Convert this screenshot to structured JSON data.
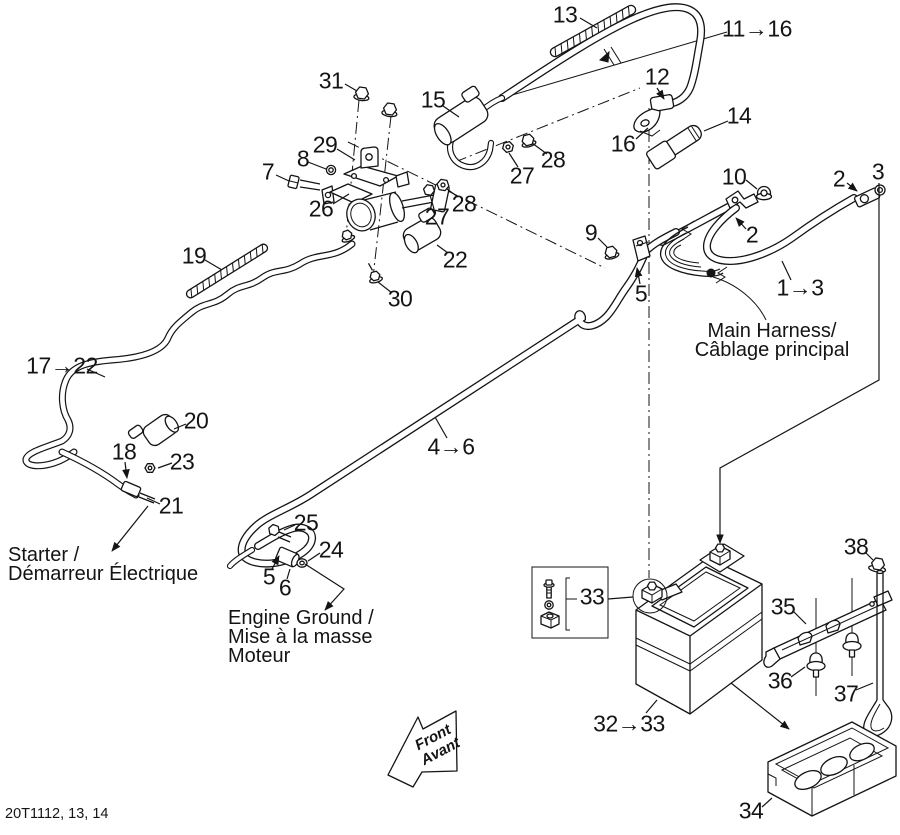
{
  "page": {
    "background": "#ffffff",
    "ink_color": "#141414",
    "doc_code": "20T1112, 13, 14"
  },
  "labels": {
    "main_harness": {
      "line1": "Main Harness/",
      "line2": "Câblage principal"
    },
    "starter": {
      "line1": "Starter /",
      "line2": "Démarreur Électrique"
    },
    "engine_ground": {
      "line1": "Engine Ground /",
      "line2": "Mise à la masse",
      "line3": "Moteur"
    },
    "front_arrow": {
      "line1": "Front",
      "line2": "Avant"
    }
  },
  "callouts": [
    {
      "id": "13",
      "label": "13",
      "x": 565,
      "y": 15
    },
    {
      "id": "31",
      "label": "31",
      "x": 331,
      "y": 81
    },
    {
      "id": "15",
      "label": "15",
      "x": 433,
      "y": 100
    },
    {
      "id": "11-16",
      "label": "11→16",
      "x": 757,
      "y": 29
    },
    {
      "id": "12",
      "label": "12",
      "x": 657,
      "y": 77
    },
    {
      "id": "16",
      "label": "16",
      "x": 623,
      "y": 144
    },
    {
      "id": "14",
      "label": "14",
      "x": 739,
      "y": 116
    },
    {
      "id": "29",
      "label": "29",
      "x": 325,
      "y": 145
    },
    {
      "id": "8",
      "label": "8",
      "x": 303,
      "y": 159
    },
    {
      "id": "7",
      "label": "7",
      "x": 268,
      "y": 172
    },
    {
      "id": "28-upper",
      "label": "28",
      "x": 553,
      "y": 160
    },
    {
      "id": "27-upper",
      "label": "27",
      "x": 522,
      "y": 176
    },
    {
      "id": "26",
      "label": "26",
      "x": 321,
      "y": 209
    },
    {
      "id": "10",
      "label": "10",
      "x": 734,
      "y": 177
    },
    {
      "id": "2-right",
      "label": "2",
      "x": 839,
      "y": 179
    },
    {
      "id": "3",
      "label": "3",
      "x": 878,
      "y": 172
    },
    {
      "id": "28-mid",
      "label": "28",
      "x": 464,
      "y": 204
    },
    {
      "id": "27-mid",
      "label": "27",
      "x": 437,
      "y": 217
    },
    {
      "id": "22",
      "label": "22",
      "x": 455,
      "y": 260
    },
    {
      "id": "9",
      "label": "9",
      "x": 591,
      "y": 233
    },
    {
      "id": "2-left",
      "label": "2",
      "x": 752,
      "y": 235
    },
    {
      "id": "19",
      "label": "19",
      "x": 194,
      "y": 256
    },
    {
      "id": "30",
      "label": "30",
      "x": 400,
      "y": 299
    },
    {
      "id": "5-clamp",
      "label": "5",
      "x": 641,
      "y": 294
    },
    {
      "id": "1-3",
      "label": "1→3",
      "x": 800,
      "y": 288
    },
    {
      "id": "17-22",
      "label": "17→22",
      "x": 62,
      "y": 366
    },
    {
      "id": "20",
      "label": "20",
      "x": 196,
      "y": 421
    },
    {
      "id": "18",
      "label": "18",
      "x": 124,
      "y": 452
    },
    {
      "id": "23",
      "label": "23",
      "x": 182,
      "y": 462
    },
    {
      "id": "21",
      "label": "21",
      "x": 171,
      "y": 506
    },
    {
      "id": "4-6",
      "label": "4→6",
      "x": 451,
      "y": 447
    },
    {
      "id": "25",
      "label": "25",
      "x": 306,
      "y": 523
    },
    {
      "id": "24",
      "label": "24",
      "x": 331,
      "y": 550
    },
    {
      "id": "5-ground",
      "label": "5",
      "x": 269,
      "y": 577
    },
    {
      "id": "6",
      "label": "6",
      "x": 285,
      "y": 588
    },
    {
      "id": "33",
      "label": "33",
      "x": 592,
      "y": 597
    },
    {
      "id": "38",
      "label": "38",
      "x": 856,
      "y": 547
    },
    {
      "id": "35",
      "label": "35",
      "x": 783,
      "y": 607
    },
    {
      "id": "36",
      "label": "36",
      "x": 780,
      "y": 681
    },
    {
      "id": "37",
      "label": "37",
      "x": 846,
      "y": 694
    },
    {
      "id": "32-33",
      "label": "32→33",
      "x": 629,
      "y": 724
    },
    {
      "id": "34",
      "label": "34",
      "x": 751,
      "y": 811
    }
  ]
}
